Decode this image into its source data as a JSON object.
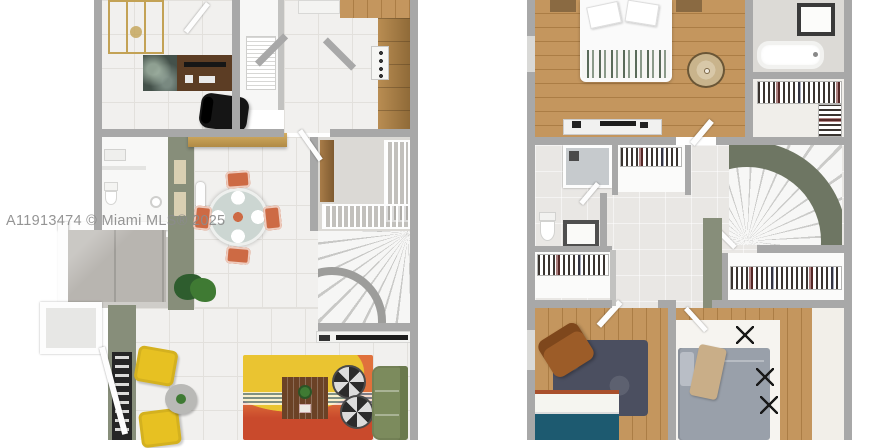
{
  "watermark": {
    "text": "A11913474 © Miami MLS® 2025"
  },
  "plans": [
    {
      "id": "first-floor",
      "rooms": [
        "office",
        "kitchen",
        "pantry-closet",
        "bathroom",
        "dining-area",
        "entry",
        "patio",
        "living-room",
        "spiral-staircase"
      ]
    },
    {
      "id": "second-floor",
      "rooms": [
        "primary-bedroom",
        "primary-bathroom",
        "walk-in-closet",
        "hall-bathroom",
        "hall-closets",
        "spiral-staircase",
        "bedroom-2",
        "bedroom-3"
      ]
    }
  ],
  "colors": {
    "page_bg": "#ffffff",
    "wall": "#a8a8a8",
    "wall_light": "#c2c2c0",
    "tile": "#f1f0ee",
    "tile_line": "#e2e0dc",
    "hall_tile": "#e9e7e4",
    "bath_tile": "#dcdad6",
    "shower_tile": "#cfcdc9",
    "concrete": "#b8b5b0",
    "wood": "#c4965e",
    "wood_dark": "#ab7d45",
    "wood_cab": "#a87c48",
    "sage": "#878e7a",
    "sage_dark": "#6e7663",
    "gold": "#c3a255",
    "desk_wood": "#5c3d24",
    "marble": "#44514a",
    "ink": "#1d1d1d",
    "orange_chair": "#cd6a44",
    "table_top": "#ccd6d2",
    "rug_orange": "#e0713c",
    "rug_yellow": "#eac431",
    "rug_red": "#c94a2c",
    "stripe_blue": "#5b7f9e",
    "sofa_green": "#7c8b5d",
    "chair_yellow": "#e7c122",
    "side_table": "#b9b9b6",
    "plant": "#3f7a33",
    "plant_dark": "#2e5d2e",
    "bed_white": "#fafafa",
    "blanket_green": "#5a6b5a",
    "jute": "#c9b48c",
    "navy_rug": "#4b4f60",
    "teal": "#1d5a70",
    "rust": "#a9502c",
    "brown": "#9c5c28",
    "gray_bed": "#99a0aa",
    "tan_throw": "#c9ae88",
    "watermark": "#8c8c8c"
  }
}
